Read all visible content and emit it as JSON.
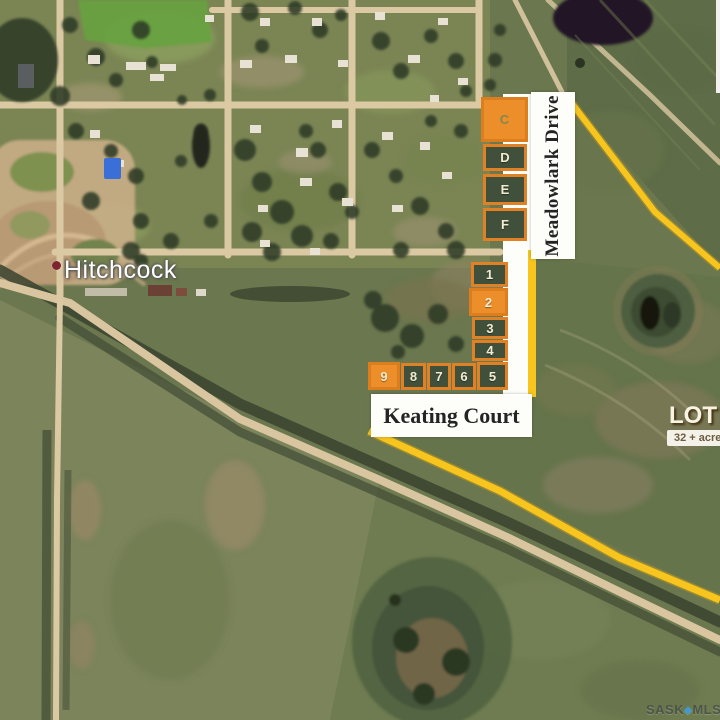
{
  "map": {
    "town_label": "Hitchcock",
    "watermark": {
      "part1": "SASK",
      "diamond": "◆",
      "part2": "MLS",
      "reg": "®"
    }
  },
  "streets": {
    "meadowlark_drive": "Meadowlark Drive",
    "keating_court": "Keating Court"
  },
  "lots": {
    "letters": [
      {
        "label": "C",
        "highlighted": true
      },
      {
        "label": "D",
        "highlighted": false
      },
      {
        "label": "E",
        "highlighted": false
      },
      {
        "label": "F",
        "highlighted": false
      }
    ],
    "numbers_column": [
      {
        "label": "1",
        "highlighted": false
      },
      {
        "label": "2",
        "highlighted": true
      },
      {
        "label": "3",
        "highlighted": false
      },
      {
        "label": "4",
        "highlighted": false
      }
    ],
    "numbers_row": [
      {
        "label": "9",
        "highlighted": true
      },
      {
        "label": "8",
        "highlighted": false
      },
      {
        "label": "7",
        "highlighted": false
      },
      {
        "label": "6",
        "highlighted": false
      },
      {
        "label": "5",
        "highlighted": false
      }
    ]
  },
  "parcel": {
    "title": "LOT 1",
    "acreage": "32 + acres"
  },
  "colors": {
    "lot_orange": "#EC8F2B",
    "lot_green": "#41503A",
    "boundary_yellow": "#F7C51D",
    "label_background": "#FDFDF9"
  }
}
